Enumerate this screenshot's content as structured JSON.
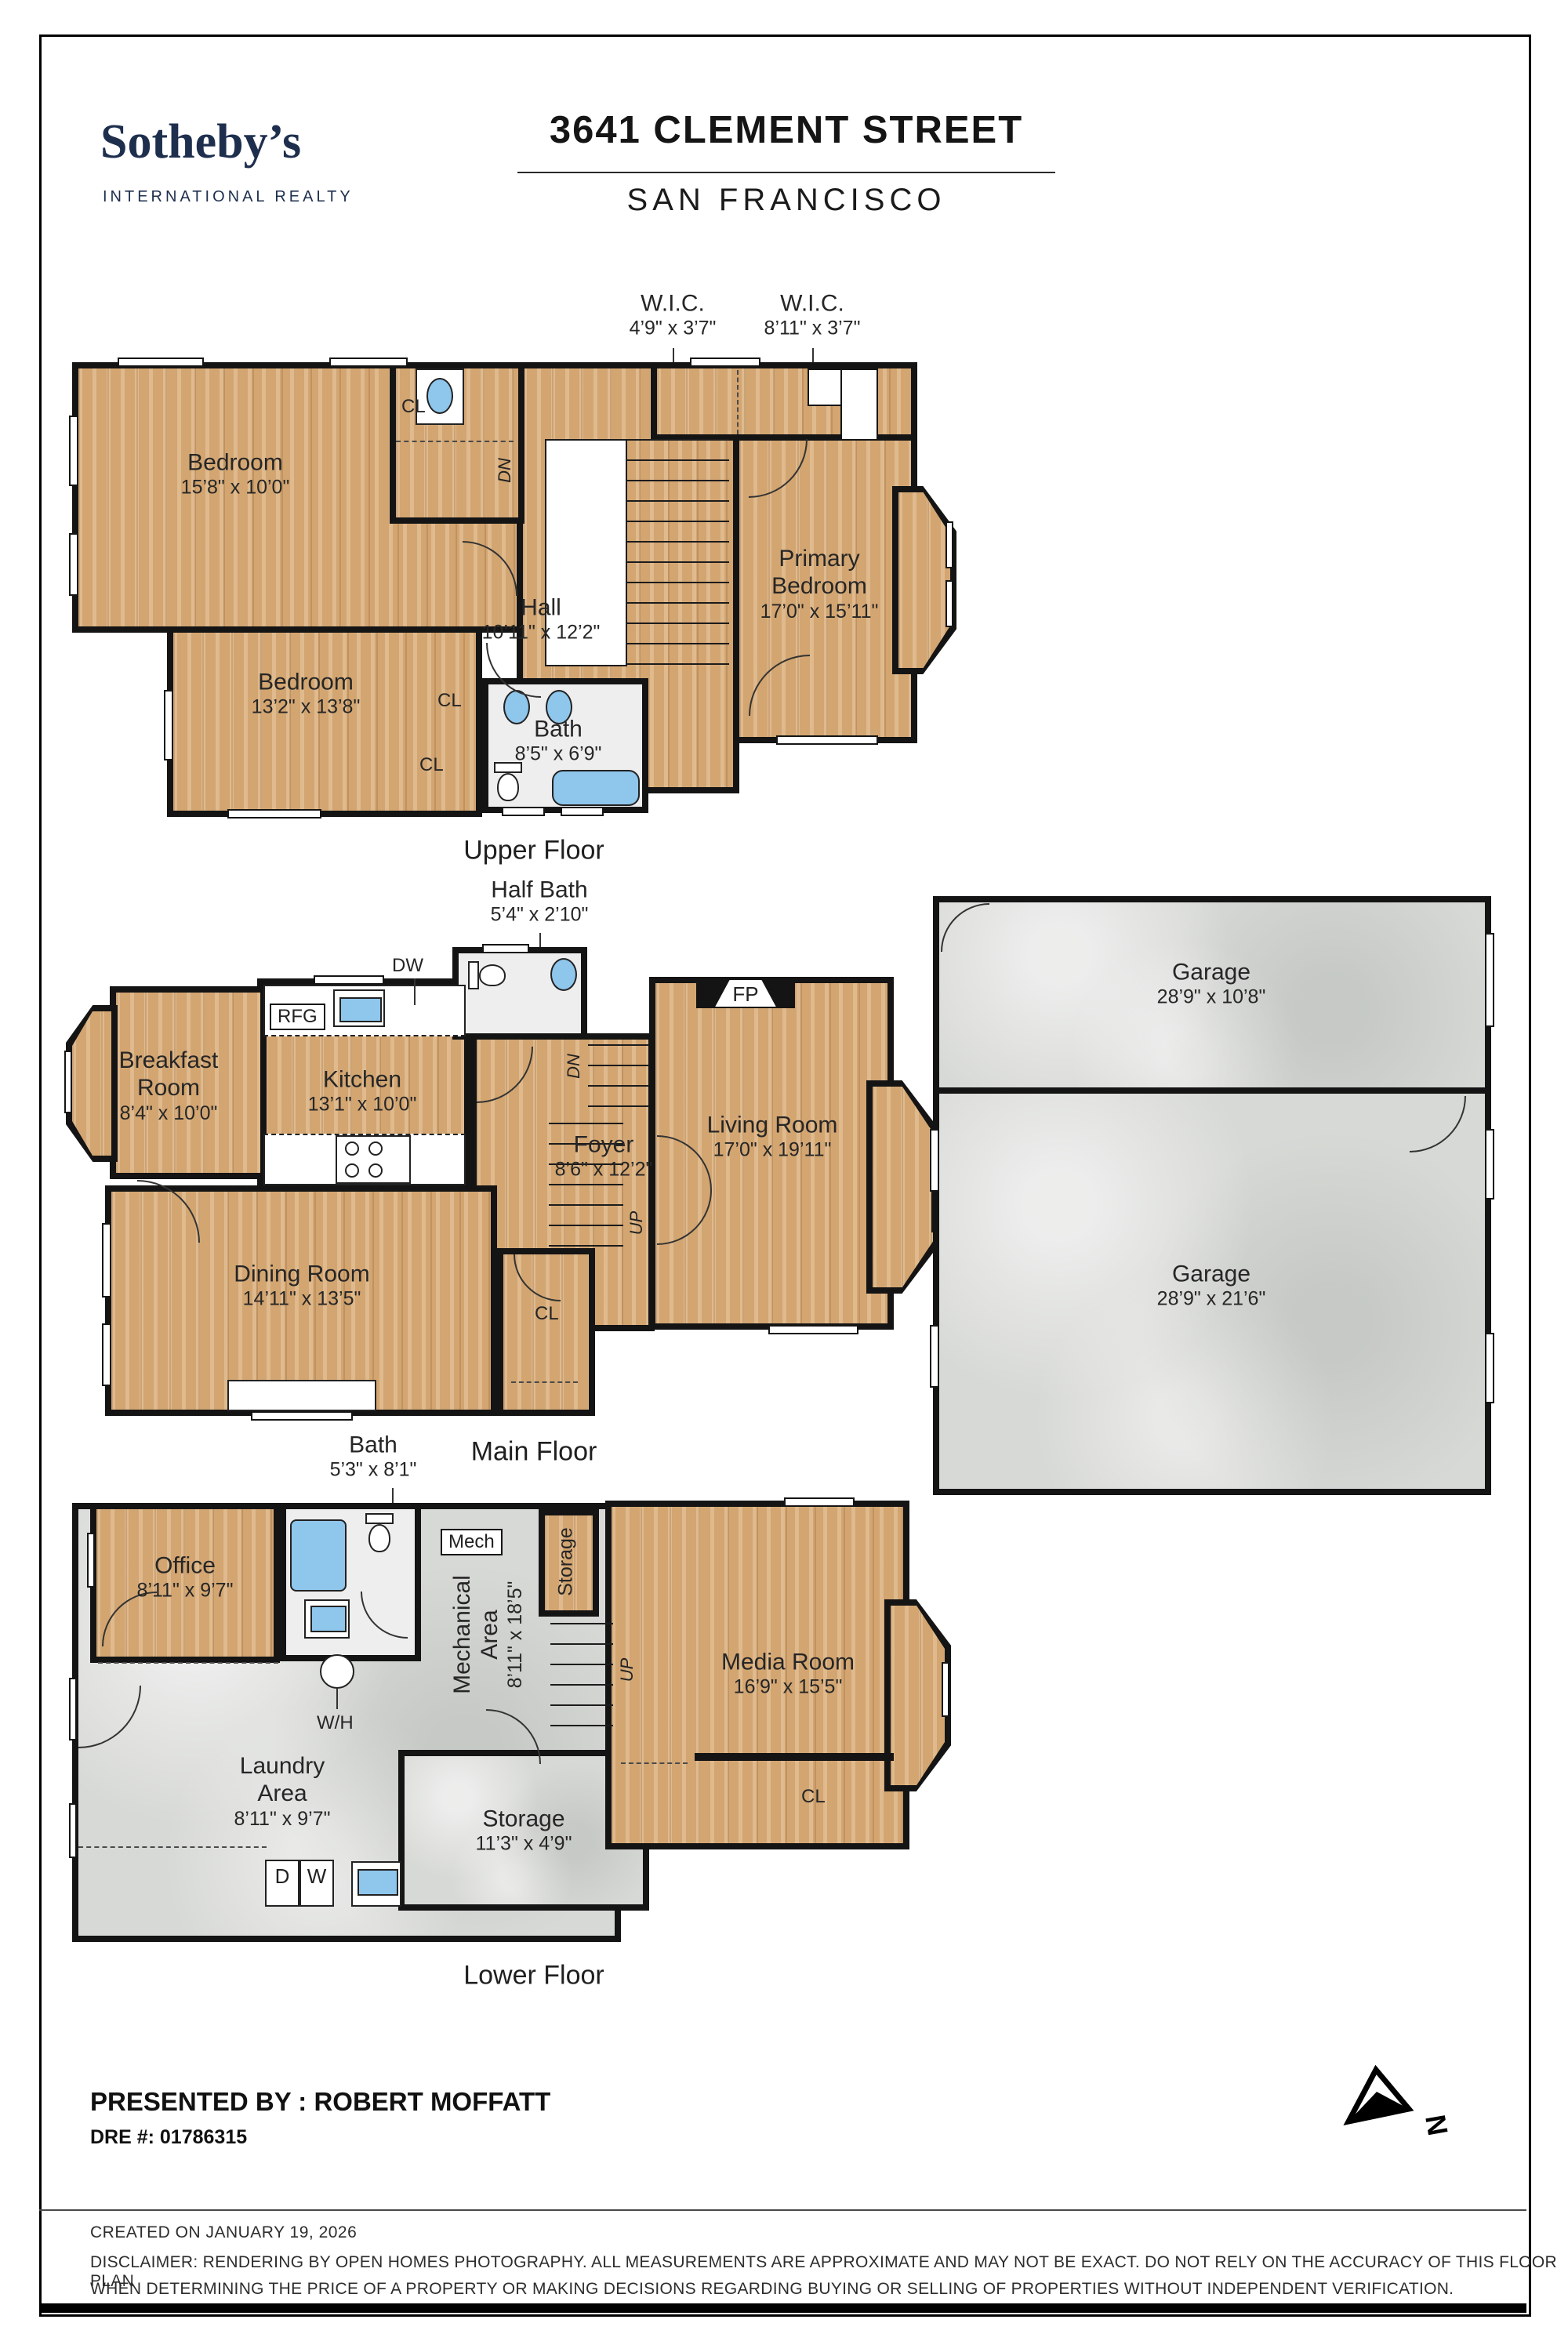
{
  "header": {
    "brand": "Sotheby’s",
    "brand_tagline": "INTERNATIONAL REALTY",
    "address": "3641 CLEMENT STREET",
    "city": "SAN FRANCISCO"
  },
  "upper_floor": {
    "floor_label": "Upper Floor",
    "wic_1": {
      "name": "W.I.C.",
      "dims": "4’9\" x 3’7\""
    },
    "wic_2": {
      "name": "W.I.C.",
      "dims": "8’11\" x 3’7\""
    },
    "bedroom_1": {
      "name": "Bedroom",
      "dims": "15’8\" x 10’0\""
    },
    "bedroom_2": {
      "name": "Bedroom",
      "dims": "13’2\" x 13’8\""
    },
    "primary_bedroom": {
      "name": "Primary Bedroom",
      "dims": "17’0\" x 15’11\""
    },
    "hall": {
      "name": "Hall",
      "dims": "10’11\" x 12’2\""
    },
    "bath": {
      "name": "Bath",
      "dims": "8’5\" x 6’9\""
    },
    "closet_label": "CL",
    "stairs_down_label": "DN"
  },
  "main_floor": {
    "floor_label": "Main Floor",
    "half_bath": {
      "name": "Half Bath",
      "dims": "5’4\" x 2’10\""
    },
    "breakfast_room": {
      "name": "Breakfast Room",
      "dims": "8’4\" x 10’0\""
    },
    "kitchen": {
      "name": "Kitchen",
      "dims": "13’1\" x 10’0\""
    },
    "living_room": {
      "name": "Living Room",
      "dims": "17’0\" x 19’11\""
    },
    "foyer": {
      "name": "Foyer",
      "dims": "8’6\" x 12’2\""
    },
    "dining_room": {
      "name": "Dining Room",
      "dims": "14’11\" x 13’5\""
    },
    "fridge_label": "RFG",
    "dishwasher_label": "DW",
    "fireplace_label": "FP",
    "closet_label": "CL",
    "stairs_down_label": "DN",
    "stairs_up_label": "UP"
  },
  "garage": {
    "garage_1": {
      "name": "Garage",
      "dims": "28’9\" x 10’8\""
    },
    "garage_2": {
      "name": "Garage",
      "dims": "28’9\" x 21’6\""
    }
  },
  "lower_floor": {
    "floor_label": "Lower Floor",
    "bath": {
      "name": "Bath",
      "dims": "5’3\" x 8’1\""
    },
    "office": {
      "name": "Office",
      "dims": "8’11\" x 9’7\""
    },
    "mechanical_area": {
      "name": "Mechanical Area",
      "dims": "8’11\" x 18’5\""
    },
    "media_room": {
      "name": "Media Room",
      "dims": "16’9\" x 15’5\""
    },
    "laundry_area": {
      "name": "Laundry Area",
      "dims": "8’11\" x 9’7\""
    },
    "storage": {
      "name": "Storage",
      "dims": "11’3\" x 4’9\""
    },
    "storage_small_label": "Storage",
    "mech_label": "Mech",
    "water_heater_label": "W/H",
    "dryer_label": "D",
    "washer_label": "W",
    "stairs_up_label": "UP",
    "closet_label": "CL"
  },
  "footer": {
    "presented_by": "PRESENTED BY : ROBERT MOFFATT",
    "dre": "DRE #: 01786315",
    "created": "CREATED ON JANUARY 19, 2026",
    "disclaimer_line_1": "DISCLAIMER: RENDERING BY OPEN HOMES PHOTOGRAPHY. ALL MEASUREMENTS ARE APPROXIMATE AND MAY NOT BE EXACT. DO NOT RELY ON THE ACCURACY OF THIS FLOOR PLAN",
    "disclaimer_line_2": "WHEN DETERMINING THE PRICE OF A PROPERTY OR MAKING DECISIONS REGARDING BUYING OR SELLING OF PROPERTIES WITHOUT INDEPENDENT VERIFICATION.",
    "north_label": "N"
  },
  "colors": {
    "wood": "#d3a571",
    "concrete": "#d7d9d6",
    "wall": "#141414",
    "fixture_blue": "#8ec6ec",
    "brand_navy": "#1e2f4e"
  }
}
